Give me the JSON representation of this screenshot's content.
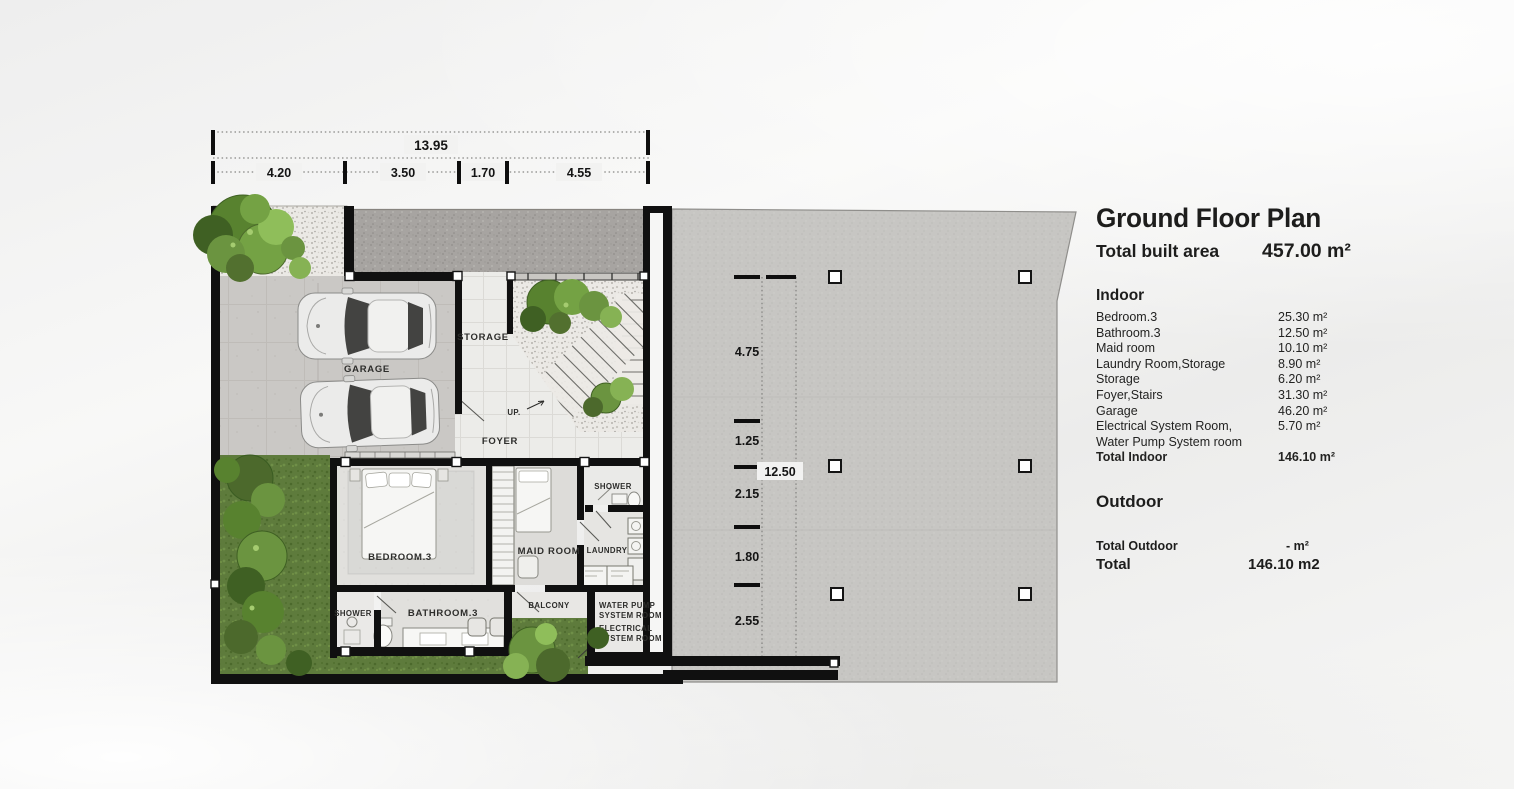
{
  "legend": {
    "title": "Ground Floor Plan",
    "built_area_label": "Total built area",
    "built_area_value": "457.00 m²",
    "indoor_heading": "Indoor",
    "indoor_rows": [
      {
        "label": "Bedroom.3",
        "value": "25.30 m²"
      },
      {
        "label": "Bathroom.3",
        "value": "12.50 m²"
      },
      {
        "label": "Maid room",
        "value": "10.10 m²"
      },
      {
        "label": "Laundry Room,Storage",
        "value": "8.90 m²"
      },
      {
        "label": "Storage",
        "value": "6.20 m²"
      },
      {
        "label": "Foyer,Stairs",
        "value": "31.30 m²"
      },
      {
        "label": "Garage",
        "value": "46.20 m²"
      },
      {
        "label": "Electrical System Room,",
        "value": "5.70 m²"
      },
      {
        "label": "Water Pump System room",
        "value": ""
      }
    ],
    "total_indoor_label": "Total Indoor",
    "total_indoor_value": "146.10 m²",
    "outdoor_heading": "Outdoor",
    "total_outdoor_label": "Total Outdoor",
    "total_outdoor_value": "-  m²",
    "total_label": "Total",
    "total_value": "146.10 m2"
  },
  "dimensions": {
    "top_overall": "13.95",
    "top_segments": [
      "4.20",
      "3.50",
      "1.70",
      "4.55"
    ],
    "left_segments": [
      "4.75",
      "1.25",
      "2.15",
      "1.80",
      "2.55"
    ],
    "left_overall": "12.50"
  },
  "rooms": {
    "garage": "GARAGE",
    "storage": "STORAGE",
    "up": "UP.",
    "foyer": "FOYER",
    "bedroom3": "BEDROOM.3",
    "maid_room": "MAID ROOM",
    "laundry": "LAUNDRY",
    "shower_upper": "SHOWER",
    "shower_lower": "SHOWER",
    "bathroom3": "BATHROOM.3",
    "balcony": "BALCONY",
    "water_pump_line1": "WATER PUMP",
    "water_pump_line2": "SYSTEM ROOM",
    "electrical_line1": "ELECTRICAL",
    "electrical_line2": "SYSTEM ROOM"
  },
  "colors": {
    "wall": "#101010",
    "grass": "#5e7b3c",
    "slab": "#c7c6c3",
    "gravel": "#ebe9e5",
    "text": "#1d1d1c"
  }
}
